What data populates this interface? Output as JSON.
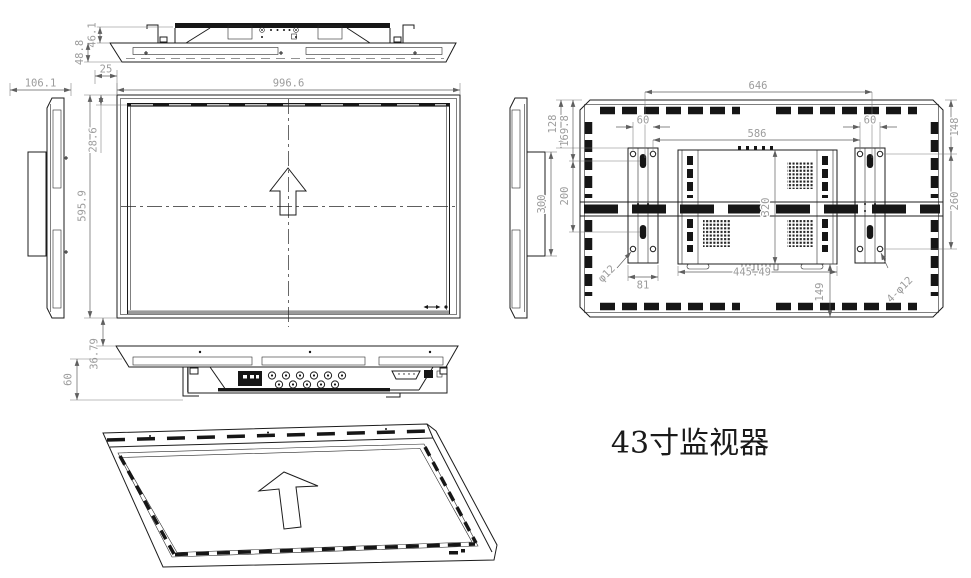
{
  "title": "43寸监视器",
  "colors": {
    "line": "#1c1c1c",
    "dim_text": "#9c9c9c",
    "background": "#ffffff",
    "screen_bottom_edge": "#9a9a9a"
  },
  "icons": {
    "front_arrow": "orientation-arrow-up",
    "iso_arrow": "orientation-arrow-up"
  },
  "dims": {
    "top_rear_height": "46.1",
    "top_total_height": "48.8",
    "top_offset": "25",
    "side_depth": "106.1",
    "front_width": "996.6",
    "front_height": "595.9",
    "front_bezel": "28.6",
    "bottom_gap": "36.79",
    "bottom_height": "60",
    "bracket_plate_height": "300",
    "rear_hole_span": "646",
    "rear_inner_span": "586",
    "rear_hole_offset_left": "60",
    "rear_hole_offset_right": "60",
    "rear_top_to_bracket": "128",
    "rear_top_to_slot": "169.8",
    "rear_slot_spacing": "200",
    "rear_bracket_width": "81",
    "rear_hole_dia": "φ12",
    "rear_top_to_hole": "148",
    "rear_hole_spacing": "260",
    "rear_hole_callout": "4-φ12",
    "rear_box_height": "320",
    "rear_box_width": "445.49",
    "rear_box_bottom_offset": "149"
  }
}
